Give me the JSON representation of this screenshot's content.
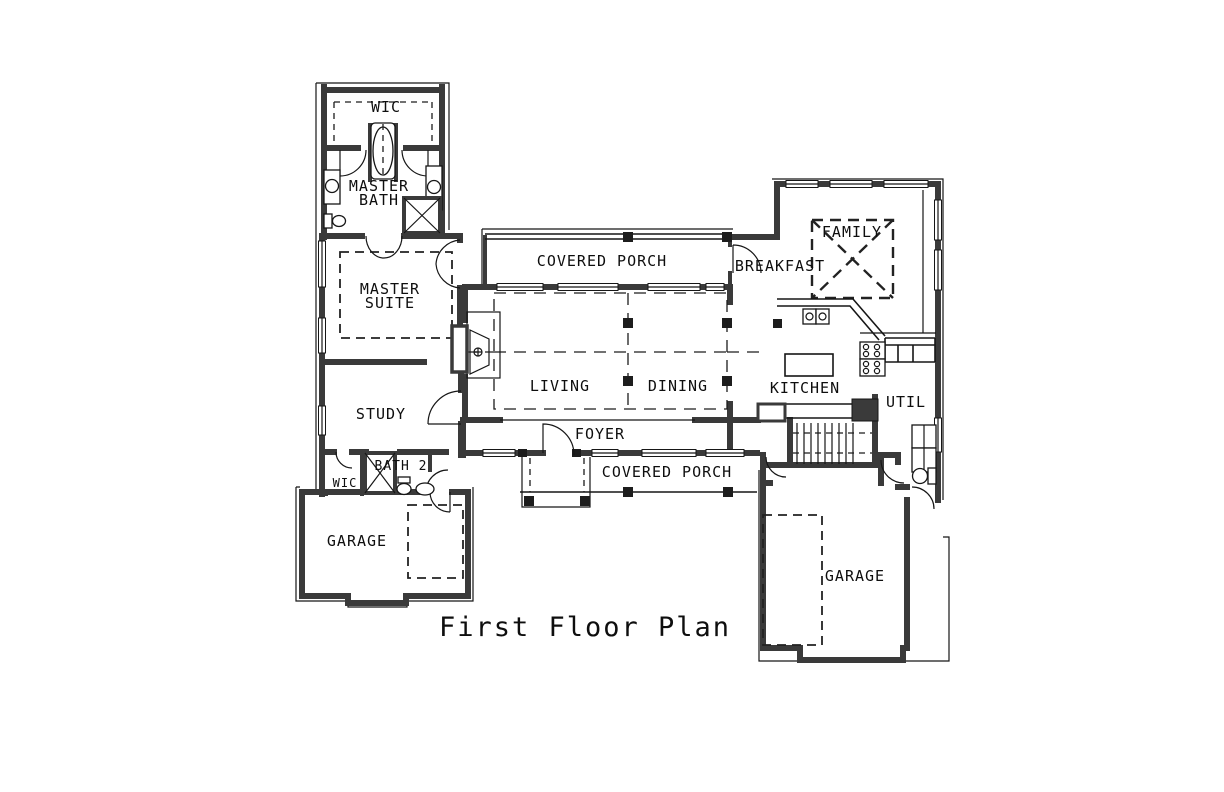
{
  "drawing": {
    "title": "First Floor Plan"
  },
  "colors": {
    "background": "#ffffff",
    "wall": "#3a3a3a",
    "line": "#161616"
  },
  "rooms": {
    "wic_top": "WIC",
    "master_bath_line1": "MASTER",
    "master_bath_line2": "BATH",
    "master_suite_line1": "MASTER",
    "master_suite_line2": "SUITE",
    "covered_porch_top": "COVERED PORCH",
    "breakfast": "BREAKFAST",
    "family": "FAMILY",
    "living": "LIVING",
    "dining": "DINING",
    "kitchen": "KITCHEN",
    "util": "UTIL",
    "study": "STUDY",
    "foyer": "FOYER",
    "bath2": "BATH 2",
    "wic_small": "WIC",
    "garage_left": "GARAGE",
    "covered_porch_bottom": "COVERED PORCH",
    "garage_right": "GARAGE"
  }
}
